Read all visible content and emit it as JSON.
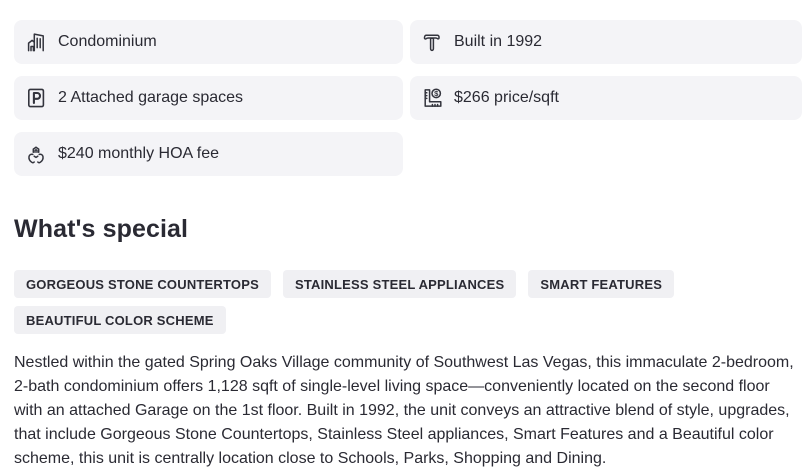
{
  "colors": {
    "page_bg": "#ffffff",
    "card_bg": "#f4f4f7",
    "tag_bg": "#f0f0f3",
    "text": "#2a2a33",
    "icon_stroke": "#33343d"
  },
  "facts": [
    {
      "icon": "building-icon",
      "label": "Condominium"
    },
    {
      "icon": "hammer-icon",
      "label": "Built in 1992"
    },
    {
      "icon": "parking-icon",
      "label": "2 Attached garage spaces"
    },
    {
      "icon": "ruler-dollar-icon",
      "label": "$266 price/sqft"
    },
    {
      "icon": "hoa-hands-icon",
      "label": "$240 monthly HOA fee"
    }
  ],
  "whats_special": {
    "heading": "What's special",
    "tags": [
      "GORGEOUS STONE COUNTERTOPS",
      "STAINLESS STEEL APPLIANCES",
      "SMART FEATURES",
      "BEAUTIFUL COLOR SCHEME"
    ],
    "description": "Nestled within the gated Spring Oaks Village community of Southwest Las Vegas, this immaculate 2-bedroom, 2-bath condominium offers 1,128 sqft of single-level living space—conveniently located on the second floor with an attached Garage on the 1st floor. Built in 1992, the unit conveys an attractive blend of style, upgrades, that include Gorgeous Stone Countertops, Stainless Steel appliances, Smart Features and a Beautiful color scheme, this unit is centrally location close to Schools, Parks, Shopping and Dining."
  }
}
